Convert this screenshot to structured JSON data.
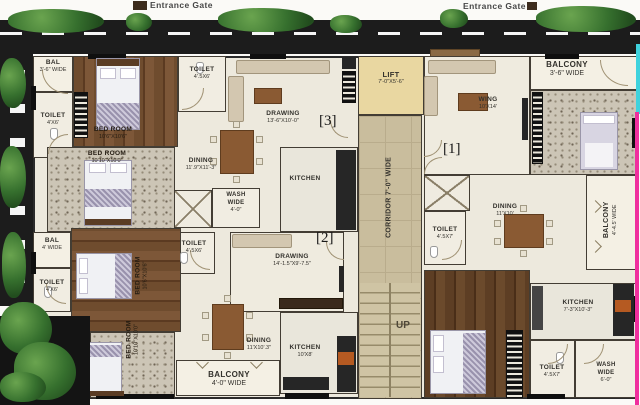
{
  "site": {
    "entrance_gate_left": "Entrance Gate",
    "entrance_gate_right": "Entrance Gate"
  },
  "core": {
    "lift_name": "LIFT",
    "lift_dims": "7'-0\"X5'-6\"",
    "corridor_label": "CORRIDOR 7'-0\" WIDE",
    "up_label": "UP",
    "unit1_label": "[1]",
    "unit2_label": "[2]",
    "unit3_label": "[3]"
  },
  "flat3": {
    "bal_name": "BAL",
    "bal_dims": "3'-6\" WIDE",
    "toilet_left_name": "TOILET",
    "toilet_left_dims": "4'X6'",
    "bedroom1_name": "BED ROOM",
    "bedroom1_dims": "10'6\"X10'6\"",
    "toilet_top_name": "TOILET",
    "toilet_top_dims": "4'.5X6'",
    "bedroom2_name": "BED ROOM",
    "bedroom2_dims": "10'10\"X10'0\"",
    "drawing_name": "DRAWING",
    "drawing_dims": "13'-6\"X10'-0\"",
    "dining_name": "DINING",
    "dining_dims": "11'.9\"X11'-3\"",
    "wash_line1": "WASH",
    "wash_line2": "WIDE",
    "wash_dims": "4'-0\"",
    "kitchen_name": "KITCHEN",
    "toilet_mid_name": "TOILET",
    "toilet_mid_dims": "4'.5X6'"
  },
  "flat2": {
    "bal_name": "BAL",
    "bal_dims": "4' WIDE",
    "toilet_name": "TOILET",
    "toilet_dims": "4'X6'",
    "bedroom1_name": "BED ROOM",
    "bedroom1_dims": "10'6\"X10'6\"",
    "bedroom2_name": "BED ROOM",
    "bedroom2_dims": "10'10\"X10'0\"",
    "drawing_name": "DRAWING",
    "drawing_dims": "14'-1.5\"X9'-7.5\"",
    "dining_name": "DINING",
    "dining_dims": "11'X10'.3\"",
    "kitchen_name": "KITCHEN",
    "kitchen_dims": "10'X8'",
    "balcony_name": "BALCONY",
    "balcony_dims": "4'-0\" WIDE"
  },
  "flat1": {
    "balcony_top_name": "BALCONY",
    "balcony_top_dims": "3'-6\" WIDE",
    "drawing_name": "WING",
    "drawing_dims": "10'X14'",
    "toilet_mid_name": "TOILET",
    "toilet_mid_dims": "4'.5X7'",
    "dining_name": "DINING",
    "dining_dims": "11'X10'",
    "balcony_right_name": "BALCONY",
    "balcony_right_dims": "4'-4.5' WIDE",
    "kitchen_name": "KITCHEN",
    "kitchen_dims": "7'-3\"X10'-3\"",
    "toilet_bottom_name": "TOILET",
    "toilet_bottom_dims": "4'.5X7'",
    "wash_line1": "WASH",
    "wash_line2": "WIDE",
    "wash_dims": "6'-0\""
  },
  "colors": {
    "road": "#1c1c1c",
    "corridor_tan": "#c9bd9d",
    "lift_yellow": "#e9d7a1",
    "boundary_magenta": "#ef2f9e",
    "boundary_cyan": "#3fd2dd",
    "hedge_green": "#36702e"
  }
}
